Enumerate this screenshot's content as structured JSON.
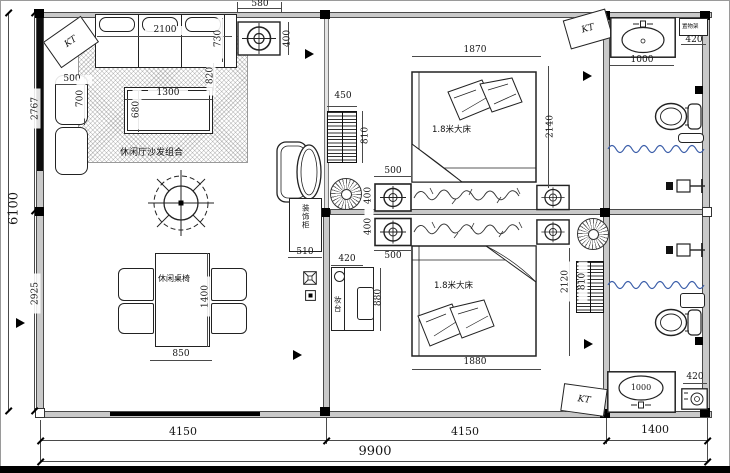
{
  "drawing": {
    "marker_label": "KT",
    "living": {
      "sofa_group_label": "休闲厅沙发组合",
      "dining_label": "休闲桌椅",
      "cabinet_label": "装饰柜"
    },
    "bedrooms": {
      "bed_top_label": "1.8米大床",
      "bed_bottom_label": "1.8米大床",
      "dresser_label": "妆台"
    },
    "bath": {
      "shelf_label": "置物架",
      "basin_bottom_value": "1000"
    }
  },
  "dims": {
    "fixture_w": "580",
    "fixture_h": "400",
    "sofa_w": "2100",
    "sofa_d": "730",
    "sofa_seat": "820",
    "armchair_w": "500",
    "armchair_d": "700",
    "coffee_w": "1300",
    "coffee_d": "680",
    "radiator_w": "450",
    "radiator_h": "810",
    "bed1_w": "1870",
    "bed1_l": "2140",
    "bed2_w": "1880",
    "bed2_l": "2120",
    "nightstand_w": "500",
    "nightstand_d": "400",
    "cabinet_w": "510",
    "dresser_w": "420",
    "dresser_l": "880",
    "dining_w": "850",
    "dining_l": "1400",
    "basin_w": "1000",
    "shelf_w": "420",
    "total_w": "9900",
    "seg_left": "4150",
    "seg_mid": "4150",
    "seg_right": "1400",
    "total_h": "6100",
    "h_top": "2767",
    "h_bottom": "2925"
  },
  "colors": {
    "wave_blue": "#3b5ea9",
    "wall_gray": "#c9c9c9"
  }
}
